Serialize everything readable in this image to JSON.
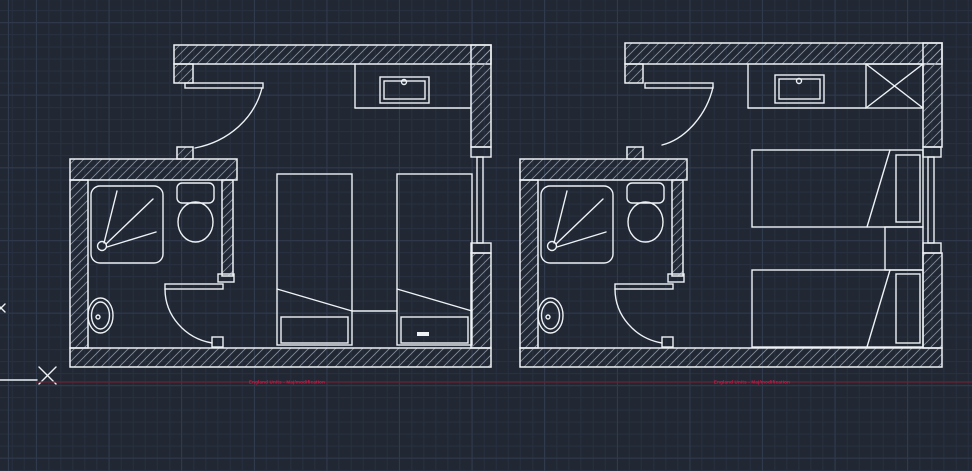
{
  "colors": {
    "background": "#212834",
    "grid_minor": "#283040",
    "grid_major": "#2f3a4d",
    "drawing_line": "#eef2f5",
    "wall_hatch": "#949caa",
    "construction_line": "#6b2330",
    "label_text": "#d01746"
  },
  "grid": {
    "minor_spacing": 12.1,
    "major_spacing": 72.6
  },
  "annotations": {
    "left_label": {
      "text": "England Units - Maj/modification",
      "x": 287,
      "y": 382
    },
    "right_label": {
      "text": "England Units - Maj/modification",
      "x": 752,
      "y": 382
    },
    "primitives": [
      {
        "t": "line",
        "x1": 0,
        "y1": 380,
        "x2": 37,
        "y2": 380,
        "name": "axis-line"
      },
      {
        "t": "line",
        "x1": 39,
        "y1": 367,
        "x2": 56,
        "y2": 384,
        "name": "point-marker"
      },
      {
        "t": "line",
        "x1": 39,
        "y1": 384,
        "x2": 56,
        "y2": 367,
        "name": "point-marker"
      },
      {
        "t": "line",
        "x1": 36,
        "y1": 382,
        "x2": 972,
        "y2": 382,
        "cls": "red",
        "name": "construction-line"
      },
      {
        "t": "line",
        "x1": -3,
        "y1": 304,
        "x2": 5,
        "y2": 312,
        "name": "edge-marker"
      },
      {
        "t": "line",
        "x1": -3,
        "y1": 312,
        "x2": 5,
        "y2": 304,
        "name": "edge-marker"
      }
    ]
  },
  "left_plan": {
    "name": "twin-room-plan-left",
    "primitives": [
      {
        "t": "wrect",
        "x": 174,
        "y": 45,
        "w": 317,
        "h": 19,
        "name": "top-wall"
      },
      {
        "t": "wrect",
        "x": 174,
        "y": 64,
        "w": 19,
        "h": 19,
        "name": "door-jamb"
      },
      {
        "t": "wrect",
        "x": 177,
        "y": 147,
        "w": 16,
        "h": 12,
        "name": "door-stop"
      },
      {
        "t": "wrect",
        "x": 70,
        "y": 159,
        "w": 167,
        "h": 21,
        "name": "bathroom-wall"
      },
      {
        "t": "wrect",
        "x": 222,
        "y": 180,
        "w": 11,
        "h": 96,
        "name": "bathroom-partition"
      },
      {
        "t": "wrect",
        "x": 70,
        "y": 180,
        "w": 18,
        "h": 168,
        "name": "left-wall"
      },
      {
        "t": "wrect",
        "x": 70,
        "y": 348,
        "w": 421,
        "h": 19,
        "name": "bottom-wall"
      },
      {
        "t": "wrect",
        "x": 471,
        "y": 45,
        "w": 20,
        "h": 102,
        "name": "right-wall-upper"
      },
      {
        "t": "wrect",
        "x": 471,
        "y": 253,
        "w": 20,
        "h": 95,
        "name": "right-wall-lower"
      },
      {
        "t": "rect",
        "x": 185,
        "y": 83,
        "w": 78,
        "h": 5,
        "name": "entry-door-leaf"
      },
      {
        "t": "path",
        "d": "M 262,88 C 255,116 231,141 195,148",
        "name": "entry-door-swing"
      },
      {
        "t": "line",
        "x1": 355,
        "y1": 64,
        "x2": 355,
        "y2": 108,
        "name": "counter-edge"
      },
      {
        "t": "line",
        "x1": 355,
        "y1": 108,
        "x2": 471,
        "y2": 108,
        "name": "counter-front"
      },
      {
        "t": "rect",
        "x": 380,
        "y": 77,
        "w": 49,
        "h": 26,
        "name": "sink-outer"
      },
      {
        "t": "rect",
        "x": 384,
        "y": 81,
        "w": 41,
        "h": 18,
        "name": "sink-inner"
      },
      {
        "t": "circle",
        "cx": 404,
        "cy": 82,
        "r": 2.5,
        "name": "sink-tap"
      },
      {
        "t": "rect",
        "x": 91,
        "y": 186,
        "w": 72,
        "h": 77,
        "r": 9,
        "name": "shower-tray"
      },
      {
        "t": "circle",
        "cx": 102,
        "cy": 246,
        "r": 4.5,
        "name": "shower-drain"
      },
      {
        "t": "line",
        "x1": 104,
        "y1": 243,
        "x2": 117,
        "y2": 191,
        "name": "shower-spray"
      },
      {
        "t": "line",
        "x1": 106,
        "y1": 244,
        "x2": 153,
        "y2": 199,
        "name": "shower-spray"
      },
      {
        "t": "line",
        "x1": 107,
        "y1": 247,
        "x2": 156,
        "y2": 232,
        "name": "shower-spray"
      },
      {
        "t": "rect",
        "x": 177,
        "y": 183,
        "w": 37,
        "h": 20,
        "r": 5,
        "name": "toilet-cistern"
      },
      {
        "t": "ellipse",
        "cx": 195.5,
        "cy": 222,
        "rx": 17.5,
        "ry": 20,
        "name": "toilet-bowl"
      },
      {
        "t": "ellipse",
        "cx": 100.5,
        "cy": 315.5,
        "rx": 12.5,
        "ry": 17.5,
        "name": "basin-outer"
      },
      {
        "t": "ellipse",
        "cx": 100.5,
        "cy": 315.5,
        "rx": 9,
        "ry": 13.5,
        "name": "basin-inner"
      },
      {
        "t": "circle",
        "cx": 98,
        "cy": 317,
        "r": 2,
        "name": "basin-drain"
      },
      {
        "t": "rect",
        "x": 165,
        "y": 284,
        "w": 58,
        "h": 5,
        "name": "bath-door-leaf"
      },
      {
        "t": "path",
        "d": "M 165,289 A 57,55 0 0 0 212,343",
        "name": "bath-door-swing"
      },
      {
        "t": "rect",
        "x": 212,
        "y": 337,
        "w": 11,
        "h": 10,
        "name": "bath-door-stop"
      },
      {
        "t": "rect",
        "x": 218,
        "y": 274,
        "w": 16,
        "h": 8,
        "name": "partition-end"
      },
      {
        "t": "rect",
        "x": 277,
        "y": 174,
        "w": 75,
        "h": 171,
        "name": "bed"
      },
      {
        "t": "line",
        "x1": 277,
        "y1": 289,
        "x2": 352,
        "y2": 311,
        "name": "bed-fold"
      },
      {
        "t": "rect",
        "x": 281,
        "y": 317,
        "w": 67,
        "h": 26,
        "name": "pillow"
      },
      {
        "t": "rect",
        "x": 397,
        "y": 174,
        "w": 75,
        "h": 171,
        "name": "bed"
      },
      {
        "t": "line",
        "x1": 397,
        "y1": 289,
        "x2": 472,
        "y2": 311,
        "name": "bed-fold"
      },
      {
        "t": "rect",
        "x": 401,
        "y": 317,
        "w": 67,
        "h": 26,
        "name": "pillow"
      },
      {
        "t": "frect",
        "x": 417,
        "y": 332,
        "w": 12,
        "h": 4,
        "name": "pillow-tag"
      },
      {
        "t": "line",
        "x1": 352,
        "y1": 311,
        "x2": 397,
        "y2": 311,
        "name": "bedside-table"
      },
      {
        "t": "rect",
        "x": 471,
        "y": 147,
        "w": 20,
        "h": 10,
        "name": "window-sill"
      },
      {
        "t": "rect",
        "x": 471,
        "y": 243,
        "w": 20,
        "h": 10,
        "name": "window-sill"
      },
      {
        "t": "rect",
        "x": 477,
        "y": 157,
        "w": 6,
        "h": 86,
        "name": "window-mullion"
      }
    ]
  },
  "right_plan": {
    "name": "twin-room-plan-right",
    "primitives": [
      {
        "t": "wrect",
        "x": 625,
        "y": 43,
        "w": 317,
        "h": 21,
        "name": "top-wall"
      },
      {
        "t": "wrect",
        "x": 625,
        "y": 64,
        "w": 18,
        "h": 19,
        "name": "door-jamb"
      },
      {
        "t": "wrect",
        "x": 627,
        "y": 147,
        "w": 16,
        "h": 12,
        "name": "door-stop"
      },
      {
        "t": "wrect",
        "x": 520,
        "y": 159,
        "w": 167,
        "h": 21,
        "name": "bathroom-wall"
      },
      {
        "t": "wrect",
        "x": 672,
        "y": 180,
        "w": 11,
        "h": 96,
        "name": "bathroom-partition"
      },
      {
        "t": "wrect",
        "x": 520,
        "y": 180,
        "w": 18,
        "h": 168,
        "name": "left-wall"
      },
      {
        "t": "wrect",
        "x": 520,
        "y": 348,
        "w": 422,
        "h": 19,
        "name": "bottom-wall"
      },
      {
        "t": "wrect",
        "x": 923,
        "y": 43,
        "w": 19,
        "h": 104,
        "name": "right-wall-upper"
      },
      {
        "t": "wrect",
        "x": 923,
        "y": 253,
        "w": 19,
        "h": 95,
        "name": "right-wall-lower"
      },
      {
        "t": "rect",
        "x": 645,
        "y": 83,
        "w": 68,
        "h": 5,
        "name": "entry-door-leaf"
      },
      {
        "t": "path",
        "d": "M 713,87 C 707,114 686,139 662,145",
        "name": "entry-door-swing"
      },
      {
        "t": "line",
        "x1": 748,
        "y1": 64,
        "x2": 748,
        "y2": 108,
        "name": "counter-edge"
      },
      {
        "t": "line",
        "x1": 748,
        "y1": 108,
        "x2": 866,
        "y2": 108,
        "name": "counter-front"
      },
      {
        "t": "rect",
        "x": 775,
        "y": 75,
        "w": 49,
        "h": 28,
        "name": "sink-outer"
      },
      {
        "t": "rect",
        "x": 779,
        "y": 79,
        "w": 41,
        "h": 20,
        "name": "sink-inner"
      },
      {
        "t": "circle",
        "cx": 799,
        "cy": 81,
        "r": 2.5,
        "name": "sink-tap"
      },
      {
        "t": "rect",
        "x": 866,
        "y": 64,
        "w": 57,
        "h": 44,
        "name": "wardrobe"
      },
      {
        "t": "line",
        "x1": 866,
        "y1": 64,
        "x2": 923,
        "y2": 108,
        "name": "wardrobe-cross"
      },
      {
        "t": "line",
        "x1": 866,
        "y1": 108,
        "x2": 923,
        "y2": 64,
        "name": "wardrobe-cross"
      },
      {
        "t": "rect",
        "x": 541,
        "y": 186,
        "w": 72,
        "h": 77,
        "r": 9,
        "name": "shower-tray"
      },
      {
        "t": "circle",
        "cx": 552,
        "cy": 246,
        "r": 4.5,
        "name": "shower-drain"
      },
      {
        "t": "line",
        "x1": 554,
        "y1": 243,
        "x2": 567,
        "y2": 191,
        "name": "shower-spray"
      },
      {
        "t": "line",
        "x1": 556,
        "y1": 244,
        "x2": 603,
        "y2": 199,
        "name": "shower-spray"
      },
      {
        "t": "line",
        "x1": 557,
        "y1": 247,
        "x2": 606,
        "y2": 232,
        "name": "shower-spray"
      },
      {
        "t": "rect",
        "x": 627,
        "y": 183,
        "w": 37,
        "h": 20,
        "r": 5,
        "name": "toilet-cistern"
      },
      {
        "t": "ellipse",
        "cx": 645.5,
        "cy": 222,
        "rx": 17.5,
        "ry": 20,
        "name": "toilet-bowl"
      },
      {
        "t": "ellipse",
        "cx": 550.5,
        "cy": 315.5,
        "rx": 12.5,
        "ry": 17.5,
        "name": "basin-outer"
      },
      {
        "t": "ellipse",
        "cx": 550.5,
        "cy": 315.5,
        "rx": 9,
        "ry": 13.5,
        "name": "basin-inner"
      },
      {
        "t": "circle",
        "cx": 548,
        "cy": 317,
        "r": 2,
        "name": "basin-drain"
      },
      {
        "t": "rect",
        "x": 615,
        "y": 284,
        "w": 58,
        "h": 5,
        "name": "bath-door-leaf"
      },
      {
        "t": "path",
        "d": "M 615,289 A 57,55 0 0 0 662,343",
        "name": "bath-door-swing"
      },
      {
        "t": "rect",
        "x": 662,
        "y": 337,
        "w": 11,
        "h": 10,
        "name": "bath-door-stop"
      },
      {
        "t": "rect",
        "x": 668,
        "y": 274,
        "w": 16,
        "h": 8,
        "name": "partition-end"
      },
      {
        "t": "rect",
        "x": 752,
        "y": 150,
        "w": 171,
        "h": 77,
        "name": "bed"
      },
      {
        "t": "line",
        "x1": 890,
        "y1": 150,
        "x2": 867,
        "y2": 227,
        "name": "bed-fold"
      },
      {
        "t": "rect",
        "x": 896,
        "y": 155,
        "w": 24,
        "h": 67,
        "name": "pillow"
      },
      {
        "t": "rect",
        "x": 752,
        "y": 270,
        "w": 171,
        "h": 77,
        "name": "bed"
      },
      {
        "t": "line",
        "x1": 890,
        "y1": 270,
        "x2": 867,
        "y2": 347,
        "name": "bed-fold"
      },
      {
        "t": "rect",
        "x": 896,
        "y": 274,
        "w": 24,
        "h": 69,
        "name": "pillow"
      },
      {
        "t": "rect",
        "x": 885,
        "y": 227,
        "w": 38,
        "h": 43,
        "name": "bedside-table"
      },
      {
        "t": "rect",
        "x": 923,
        "y": 147,
        "w": 18,
        "h": 10,
        "name": "window-sill"
      },
      {
        "t": "rect",
        "x": 923,
        "y": 243,
        "w": 18,
        "h": 10,
        "name": "window-sill"
      },
      {
        "t": "rect",
        "x": 928,
        "y": 157,
        "w": 6,
        "h": 86,
        "name": "window-mullion"
      }
    ]
  }
}
